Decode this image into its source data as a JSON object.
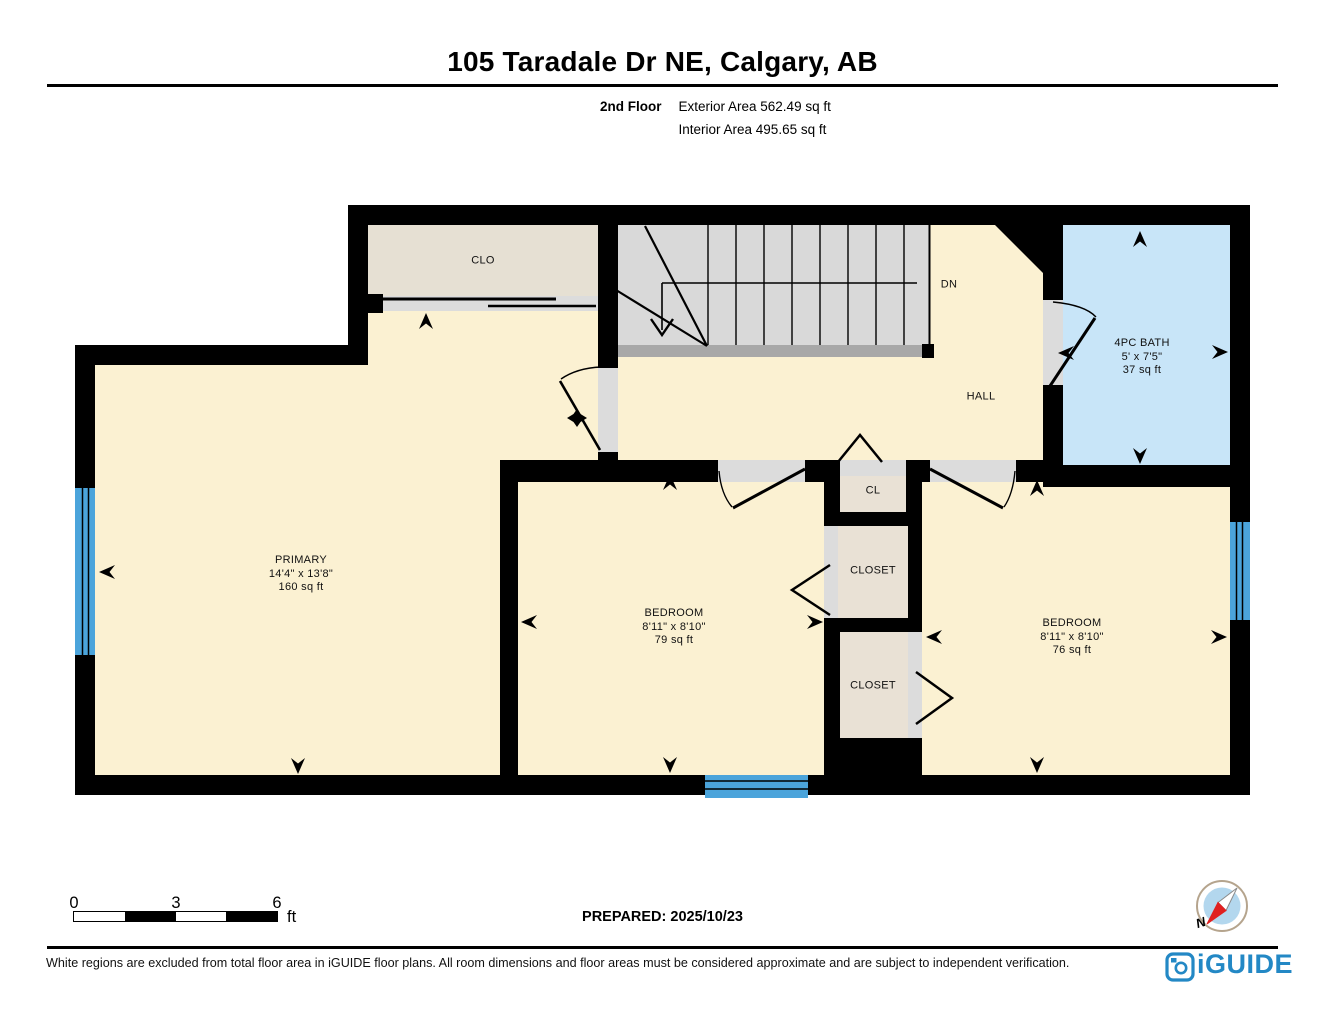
{
  "header": {
    "title": "105 Taradale Dr NE, Calgary, AB",
    "floor_label": "2nd Floor",
    "exterior_area": "Exterior Area 562.49 sq ft",
    "interior_area": "Interior Area 495.65 sq ft"
  },
  "rooms": {
    "clo": {
      "name": "CLO"
    },
    "stairs": {
      "direction_label": "DN"
    },
    "hall": {
      "name": "HALL"
    },
    "bath": {
      "name": "4PC BATH",
      "dimensions": "5' x 7'5\"",
      "area": "37 sq ft"
    },
    "primary": {
      "name": "PRIMARY",
      "dimensions": "14'4\" x 13'8\"",
      "area": "160 sq ft"
    },
    "bedroom_middle": {
      "name": "BEDROOM",
      "dimensions": "8'11\" x 8'10\"",
      "area": "79 sq ft"
    },
    "bedroom_right": {
      "name": "BEDROOM",
      "dimensions": "8'11\" x 8'10\"",
      "area": "76 sq ft"
    },
    "cl": {
      "name": "CL"
    },
    "closet_middle": {
      "name": "CLOSET"
    },
    "closet_lower": {
      "name": "CLOSET"
    }
  },
  "scale_bar": {
    "tick_0": "0",
    "tick_3": "3",
    "tick_6": "6",
    "unit": "ft"
  },
  "prepared_label": "PREPARED: 2025/10/23",
  "compass": {
    "north_label": "N"
  },
  "footer": {
    "disclaimer": "White regions are excluded from total floor area in iGUIDE floor plans. All room dimensions and floor areas must be considered approximate and are subject to independent verification.",
    "brand": "iGUIDE"
  },
  "colors": {
    "wall": "#000000",
    "room_fill": "#FBF1D2",
    "clo_fill": "#E6E0D3",
    "closet_fill": "#E9E1D5",
    "stairs_fill": "#D9D9D9",
    "stair_strip": "#A8A8A8",
    "bath_fill": "#C8E5F8",
    "window_blue": "#4BA4DB",
    "door_gap": "#DCDCDC",
    "brand_blue": "#2388C5",
    "compass_red": "#E02020",
    "compass_ring": "#B5A48D",
    "compass_inner": "#B3D7EE"
  }
}
